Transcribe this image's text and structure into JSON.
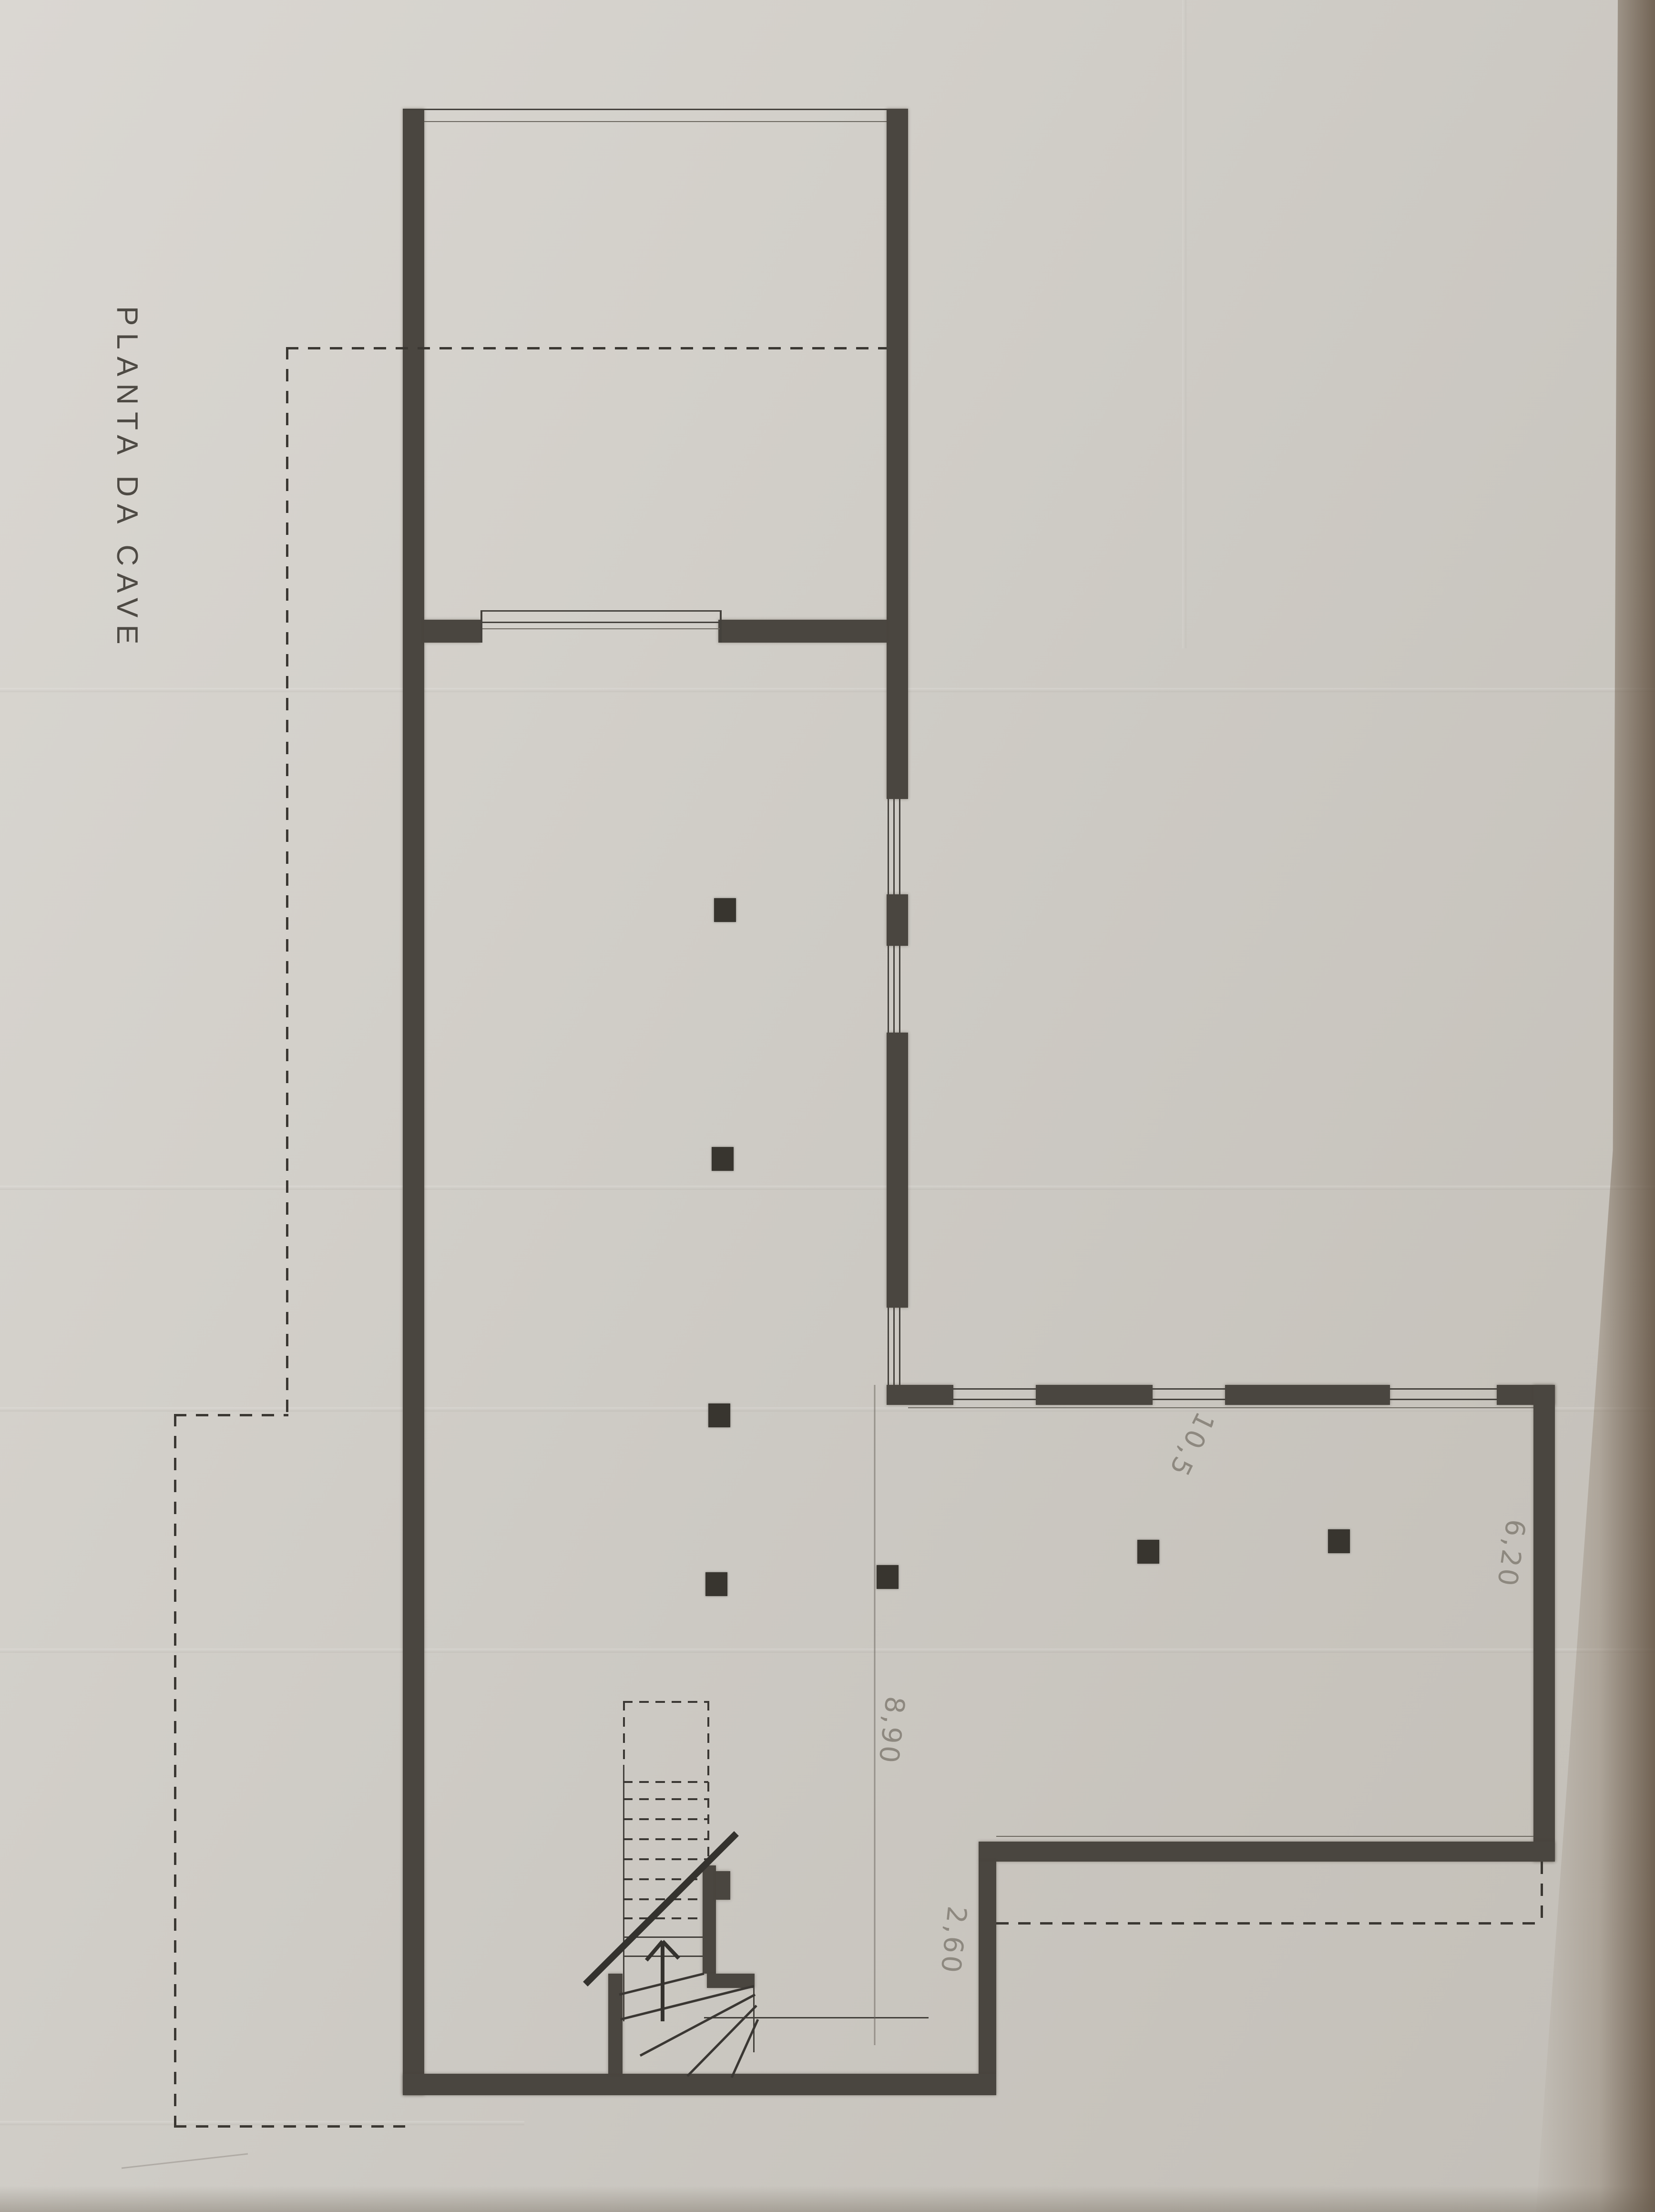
{
  "document": {
    "type": "architectural floor plan (scanned pencil drawing)",
    "title": "PLANTA DA CAVE"
  },
  "annotations": {
    "dim_8_90": "8,90",
    "dim_2_60": "2,60",
    "dim_10_5": "10,5",
    "dim_6_20": "6,20"
  },
  "colors": {
    "paper": "#d2cfc9",
    "wall_ink": "#4a4640",
    "pencil_notes": "#8d887f",
    "photo_edge_shadow": "#5c4b3a"
  }
}
